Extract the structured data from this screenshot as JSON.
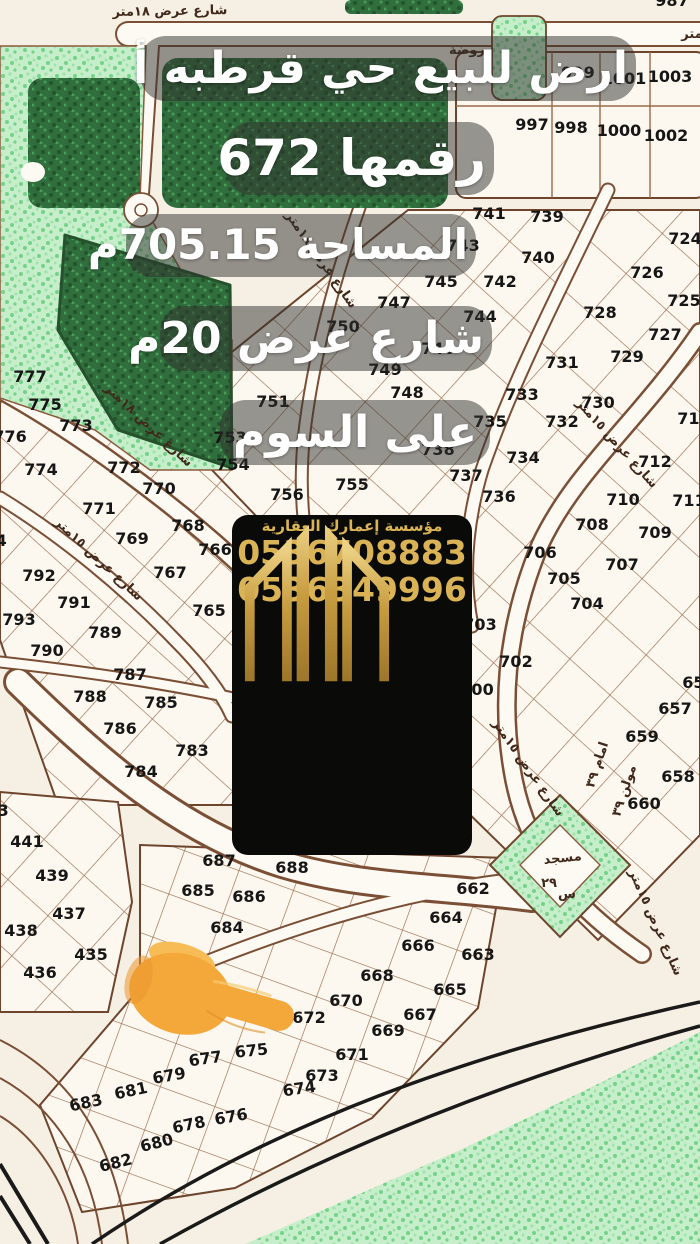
{
  "ad": {
    "lines": [
      "ارض للبيع حي قرطبه أ",
      "رقمها 672",
      "المساحة 705.15م",
      "شارع عرض 20م",
      "على السوم"
    ]
  },
  "agency": {
    "name": "مؤسسة إعمارك العقارية",
    "phone1": "0536708883",
    "phone2": "0536349996",
    "logo": "gold-towers-building-logo"
  },
  "pointer": {
    "icon": "pointing-finger-emoji",
    "points_at_plot": "672"
  },
  "colors": {
    "card_bg": "#0a0a09",
    "gold": "#d9b356",
    "overlay": "rgba(48,48,46,0.5)",
    "map_bg": "#f6f0e4",
    "plot_line": "#9a6a48",
    "park_light": "#c6eecb",
    "park_dark": "#306e3d",
    "road_black": "#1a1a1a",
    "finger": "#f4a83a"
  },
  "map": {
    "street_labels": [
      {
        "t": "شارع عرض ١٨متر",
        "x": 170,
        "y": 15,
        "r": -1,
        "s": 13
      },
      {
        "t": "متر",
        "x": 692,
        "y": 38,
        "r": 0,
        "s": 11
      },
      {
        "t": "روضة",
        "x": 467,
        "y": 54,
        "r": 0,
        "s": 12
      },
      {
        "t": "شارع عرض ١٨متر",
        "x": 146,
        "y": 428,
        "r": 43,
        "s": 13
      },
      {
        "t": "شارع عرض ١٥متر",
        "x": 96,
        "y": 562,
        "r": 43,
        "s": 13
      },
      {
        "t": "شارع عرض ١٨متر",
        "x": 318,
        "y": 262,
        "r": 55,
        "s": 13
      },
      {
        "t": "شارع عرض ١٥متر",
        "x": 614,
        "y": 446,
        "r": 48,
        "s": 13
      },
      {
        "t": "شارع عرض ١٥متر",
        "x": 525,
        "y": 770,
        "r": 55,
        "s": 13
      },
      {
        "t": "شارع عرض ١٥متر",
        "x": 652,
        "y": 924,
        "r": 66,
        "s": 12
      },
      {
        "t": "مسجد",
        "x": 563,
        "y": 862,
        "r": -6,
        "s": 14
      },
      {
        "t": "س",
        "x": 567,
        "y": 898,
        "r": 0,
        "s": 13
      },
      {
        "t": "٢٩",
        "x": 549,
        "y": 887,
        "r": 0,
        "s": 11,
        "c": "#dfa8a8"
      },
      {
        "t": "امام ٣٩",
        "x": 601,
        "y": 766,
        "r": -72,
        "s": 9
      },
      {
        "t": "مولن ٣٩",
        "x": 628,
        "y": 792,
        "r": -72,
        "s": 9
      }
    ],
    "plots": [
      {
        "n": "987",
        "x": 672,
        "y": 6
      },
      {
        "n": "999",
        "x": 578,
        "y": 78
      },
      {
        "n": "1001",
        "x": 624,
        "y": 84
      },
      {
        "n": "1003",
        "x": 670,
        "y": 82
      },
      {
        "n": "997",
        "x": 532,
        "y": 130
      },
      {
        "n": "998",
        "x": 571,
        "y": 133
      },
      {
        "n": "1000",
        "x": 619,
        "y": 136
      },
      {
        "n": "1002",
        "x": 666,
        "y": 141
      },
      {
        "n": "741",
        "x": 489,
        "y": 219
      },
      {
        "n": "739",
        "x": 547,
        "y": 222
      },
      {
        "n": "743",
        "x": 463,
        "y": 251
      },
      {
        "n": "740",
        "x": 538,
        "y": 263
      },
      {
        "n": "745",
        "x": 441,
        "y": 287
      },
      {
        "n": "742",
        "x": 500,
        "y": 287
      },
      {
        "n": "747",
        "x": 394,
        "y": 308
      },
      {
        "n": "744",
        "x": 480,
        "y": 322
      },
      {
        "n": "750",
        "x": 343,
        "y": 332
      },
      {
        "n": "746",
        "x": 438,
        "y": 354
      },
      {
        "n": "749",
        "x": 385,
        "y": 375
      },
      {
        "n": "748",
        "x": 407,
        "y": 398
      },
      {
        "n": "751",
        "x": 273,
        "y": 407
      },
      {
        "n": "735",
        "x": 490,
        "y": 427
      },
      {
        "n": "753",
        "x": 230,
        "y": 443
      },
      {
        "n": "738",
        "x": 438,
        "y": 455
      },
      {
        "n": "754",
        "x": 233,
        "y": 470
      },
      {
        "n": "737",
        "x": 466,
        "y": 481
      },
      {
        "n": "755",
        "x": 352,
        "y": 490
      },
      {
        "n": "756",
        "x": 287,
        "y": 500
      },
      {
        "n": "736",
        "x": 499,
        "y": 502
      },
      {
        "n": "724",
        "x": 685,
        "y": 244
      },
      {
        "n": "726",
        "x": 647,
        "y": 278
      },
      {
        "n": "725",
        "x": 684,
        "y": 306
      },
      {
        "n": "728",
        "x": 600,
        "y": 318
      },
      {
        "n": "727",
        "x": 665,
        "y": 340
      },
      {
        "n": "729",
        "x": 627,
        "y": 362
      },
      {
        "n": "731",
        "x": 562,
        "y": 368
      },
      {
        "n": "733",
        "x": 522,
        "y": 400
      },
      {
        "n": "730",
        "x": 598,
        "y": 408
      },
      {
        "n": "732",
        "x": 562,
        "y": 427
      },
      {
        "n": "734",
        "x": 523,
        "y": 463
      },
      {
        "n": "714",
        "x": 694,
        "y": 424
      },
      {
        "n": "712",
        "x": 655,
        "y": 467
      },
      {
        "n": "711",
        "x": 689,
        "y": 506
      },
      {
        "n": "710",
        "x": 623,
        "y": 505
      },
      {
        "n": "709",
        "x": 655,
        "y": 538
      },
      {
        "n": "708",
        "x": 592,
        "y": 530
      },
      {
        "n": "707",
        "x": 622,
        "y": 570
      },
      {
        "n": "706",
        "x": 540,
        "y": 558
      },
      {
        "n": "705",
        "x": 564,
        "y": 584
      },
      {
        "n": "704",
        "x": 587,
        "y": 609
      },
      {
        "n": "703",
        "x": 480,
        "y": 630
      },
      {
        "n": "702",
        "x": 516,
        "y": 667
      },
      {
        "n": "700",
        "x": 477,
        "y": 695
      },
      {
        "n": "656",
        "x": 699,
        "y": 688
      },
      {
        "n": "657",
        "x": 675,
        "y": 714
      },
      {
        "n": "659",
        "x": 642,
        "y": 742
      },
      {
        "n": "658",
        "x": 678,
        "y": 782
      },
      {
        "n": "660",
        "x": 644,
        "y": 809
      },
      {
        "n": "777",
        "x": 30,
        "y": 382
      },
      {
        "n": "775",
        "x": 45,
        "y": 410
      },
      {
        "n": "773",
        "x": 76,
        "y": 431
      },
      {
        "n": "776",
        "x": 10,
        "y": 442
      },
      {
        "n": "774",
        "x": 41,
        "y": 475
      },
      {
        "n": "772",
        "x": 124,
        "y": 473
      },
      {
        "n": "770",
        "x": 159,
        "y": 494
      },
      {
        "n": "771",
        "x": 99,
        "y": 514
      },
      {
        "n": "768",
        "x": 188,
        "y": 531
      },
      {
        "n": "769",
        "x": 132,
        "y": 544
      },
      {
        "n": "766",
        "x": 215,
        "y": 555
      },
      {
        "n": "767",
        "x": 170,
        "y": 578
      },
      {
        "n": "765",
        "x": 209,
        "y": 616
      },
      {
        "n": "794",
        "x": -10,
        "y": 546
      },
      {
        "n": "792",
        "x": 39,
        "y": 581
      },
      {
        "n": "791",
        "x": 74,
        "y": 608
      },
      {
        "n": "793",
        "x": 19,
        "y": 625
      },
      {
        "n": "789",
        "x": 105,
        "y": 638
      },
      {
        "n": "790",
        "x": 47,
        "y": 656
      },
      {
        "n": "787",
        "x": 130,
        "y": 680
      },
      {
        "n": "788",
        "x": 90,
        "y": 702
      },
      {
        "n": "785",
        "x": 161,
        "y": 708
      },
      {
        "n": "786",
        "x": 120,
        "y": 734
      },
      {
        "n": "783",
        "x": 192,
        "y": 756
      },
      {
        "n": "784",
        "x": 141,
        "y": 777
      },
      {
        "n": "443",
        "x": -8,
        "y": 816
      },
      {
        "n": "441",
        "x": 27,
        "y": 847
      },
      {
        "n": "439",
        "x": 52,
        "y": 881
      },
      {
        "n": "437",
        "x": 69,
        "y": 919
      },
      {
        "n": "438",
        "x": 21,
        "y": 936
      },
      {
        "n": "435",
        "x": 91,
        "y": 960
      },
      {
        "n": "436",
        "x": 40,
        "y": 978
      },
      {
        "n": "687",
        "x": 219,
        "y": 866
      },
      {
        "n": "688",
        "x": 292,
        "y": 873
      },
      {
        "n": "685",
        "x": 198,
        "y": 896
      },
      {
        "n": "686",
        "x": 249,
        "y": 902
      },
      {
        "n": "684",
        "x": 227,
        "y": 933
      },
      {
        "n": "662",
        "x": 473,
        "y": 894
      },
      {
        "n": "664",
        "x": 446,
        "y": 923
      },
      {
        "n": "666",
        "x": 418,
        "y": 951
      },
      {
        "n": "663",
        "x": 478,
        "y": 960
      },
      {
        "n": "668",
        "x": 377,
        "y": 981
      },
      {
        "n": "665",
        "x": 450,
        "y": 995
      },
      {
        "n": "670",
        "x": 346,
        "y": 1006
      },
      {
        "n": "667",
        "x": 420,
        "y": 1020
      },
      {
        "n": "672",
        "x": 309,
        "y": 1023
      },
      {
        "n": "669",
        "x": 388,
        "y": 1036
      },
      {
        "n": "671",
        "x": 352,
        "y": 1060
      },
      {
        "n": "675",
        "x": 252,
        "y": 1056,
        "r": -6
      },
      {
        "n": "677",
        "x": 206,
        "y": 1064,
        "r": -8
      },
      {
        "n": "679",
        "x": 170,
        "y": 1081,
        "r": -10
      },
      {
        "n": "673",
        "x": 322,
        "y": 1081
      },
      {
        "n": "674",
        "x": 300,
        "y": 1094,
        "r": -8
      },
      {
        "n": "681",
        "x": 132,
        "y": 1096,
        "r": -12
      },
      {
        "n": "683",
        "x": 87,
        "y": 1108,
        "r": -12
      },
      {
        "n": "676",
        "x": 232,
        "y": 1122,
        "r": -10
      },
      {
        "n": "678",
        "x": 190,
        "y": 1130,
        "r": -12
      },
      {
        "n": "680",
        "x": 158,
        "y": 1148,
        "r": -14
      },
      {
        "n": "682",
        "x": 117,
        "y": 1168,
        "r": -14
      }
    ]
  }
}
